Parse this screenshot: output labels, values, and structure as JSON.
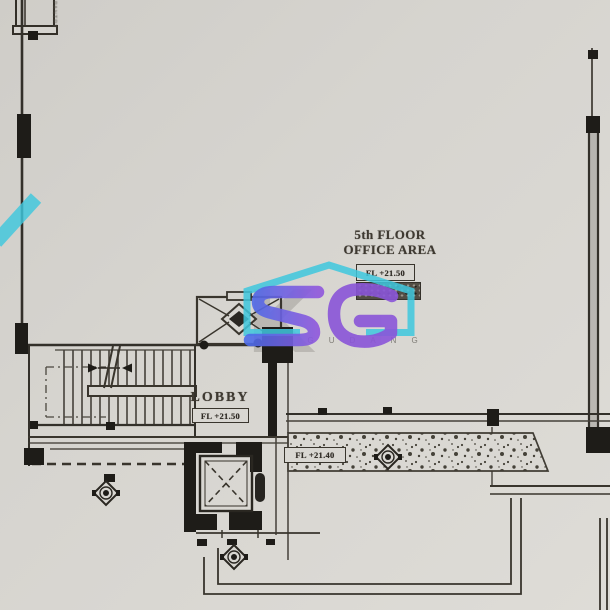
{
  "labels": {
    "floor_title_line1": "5th FLOOR",
    "floor_title_line2": "OFFICE AREA",
    "office_level": "FL +21.50",
    "lobby": "LOBBY",
    "lobby_level": "FL +21.50",
    "corridor_level": "FL +21.40",
    "top_left_vertical": "PANTRY"
  },
  "watermark": {
    "monogram": "SG",
    "wordmark": "SIGUDANG",
    "background_letter": "K",
    "house_color": "#3fc8de",
    "monogram_color_1": "#4d6be8",
    "monogram_color_2": "#8f57dd"
  },
  "colors": {
    "paper": "#d6d4cf",
    "ink": "#39352d",
    "ink_heavy": "#1e1c18"
  }
}
